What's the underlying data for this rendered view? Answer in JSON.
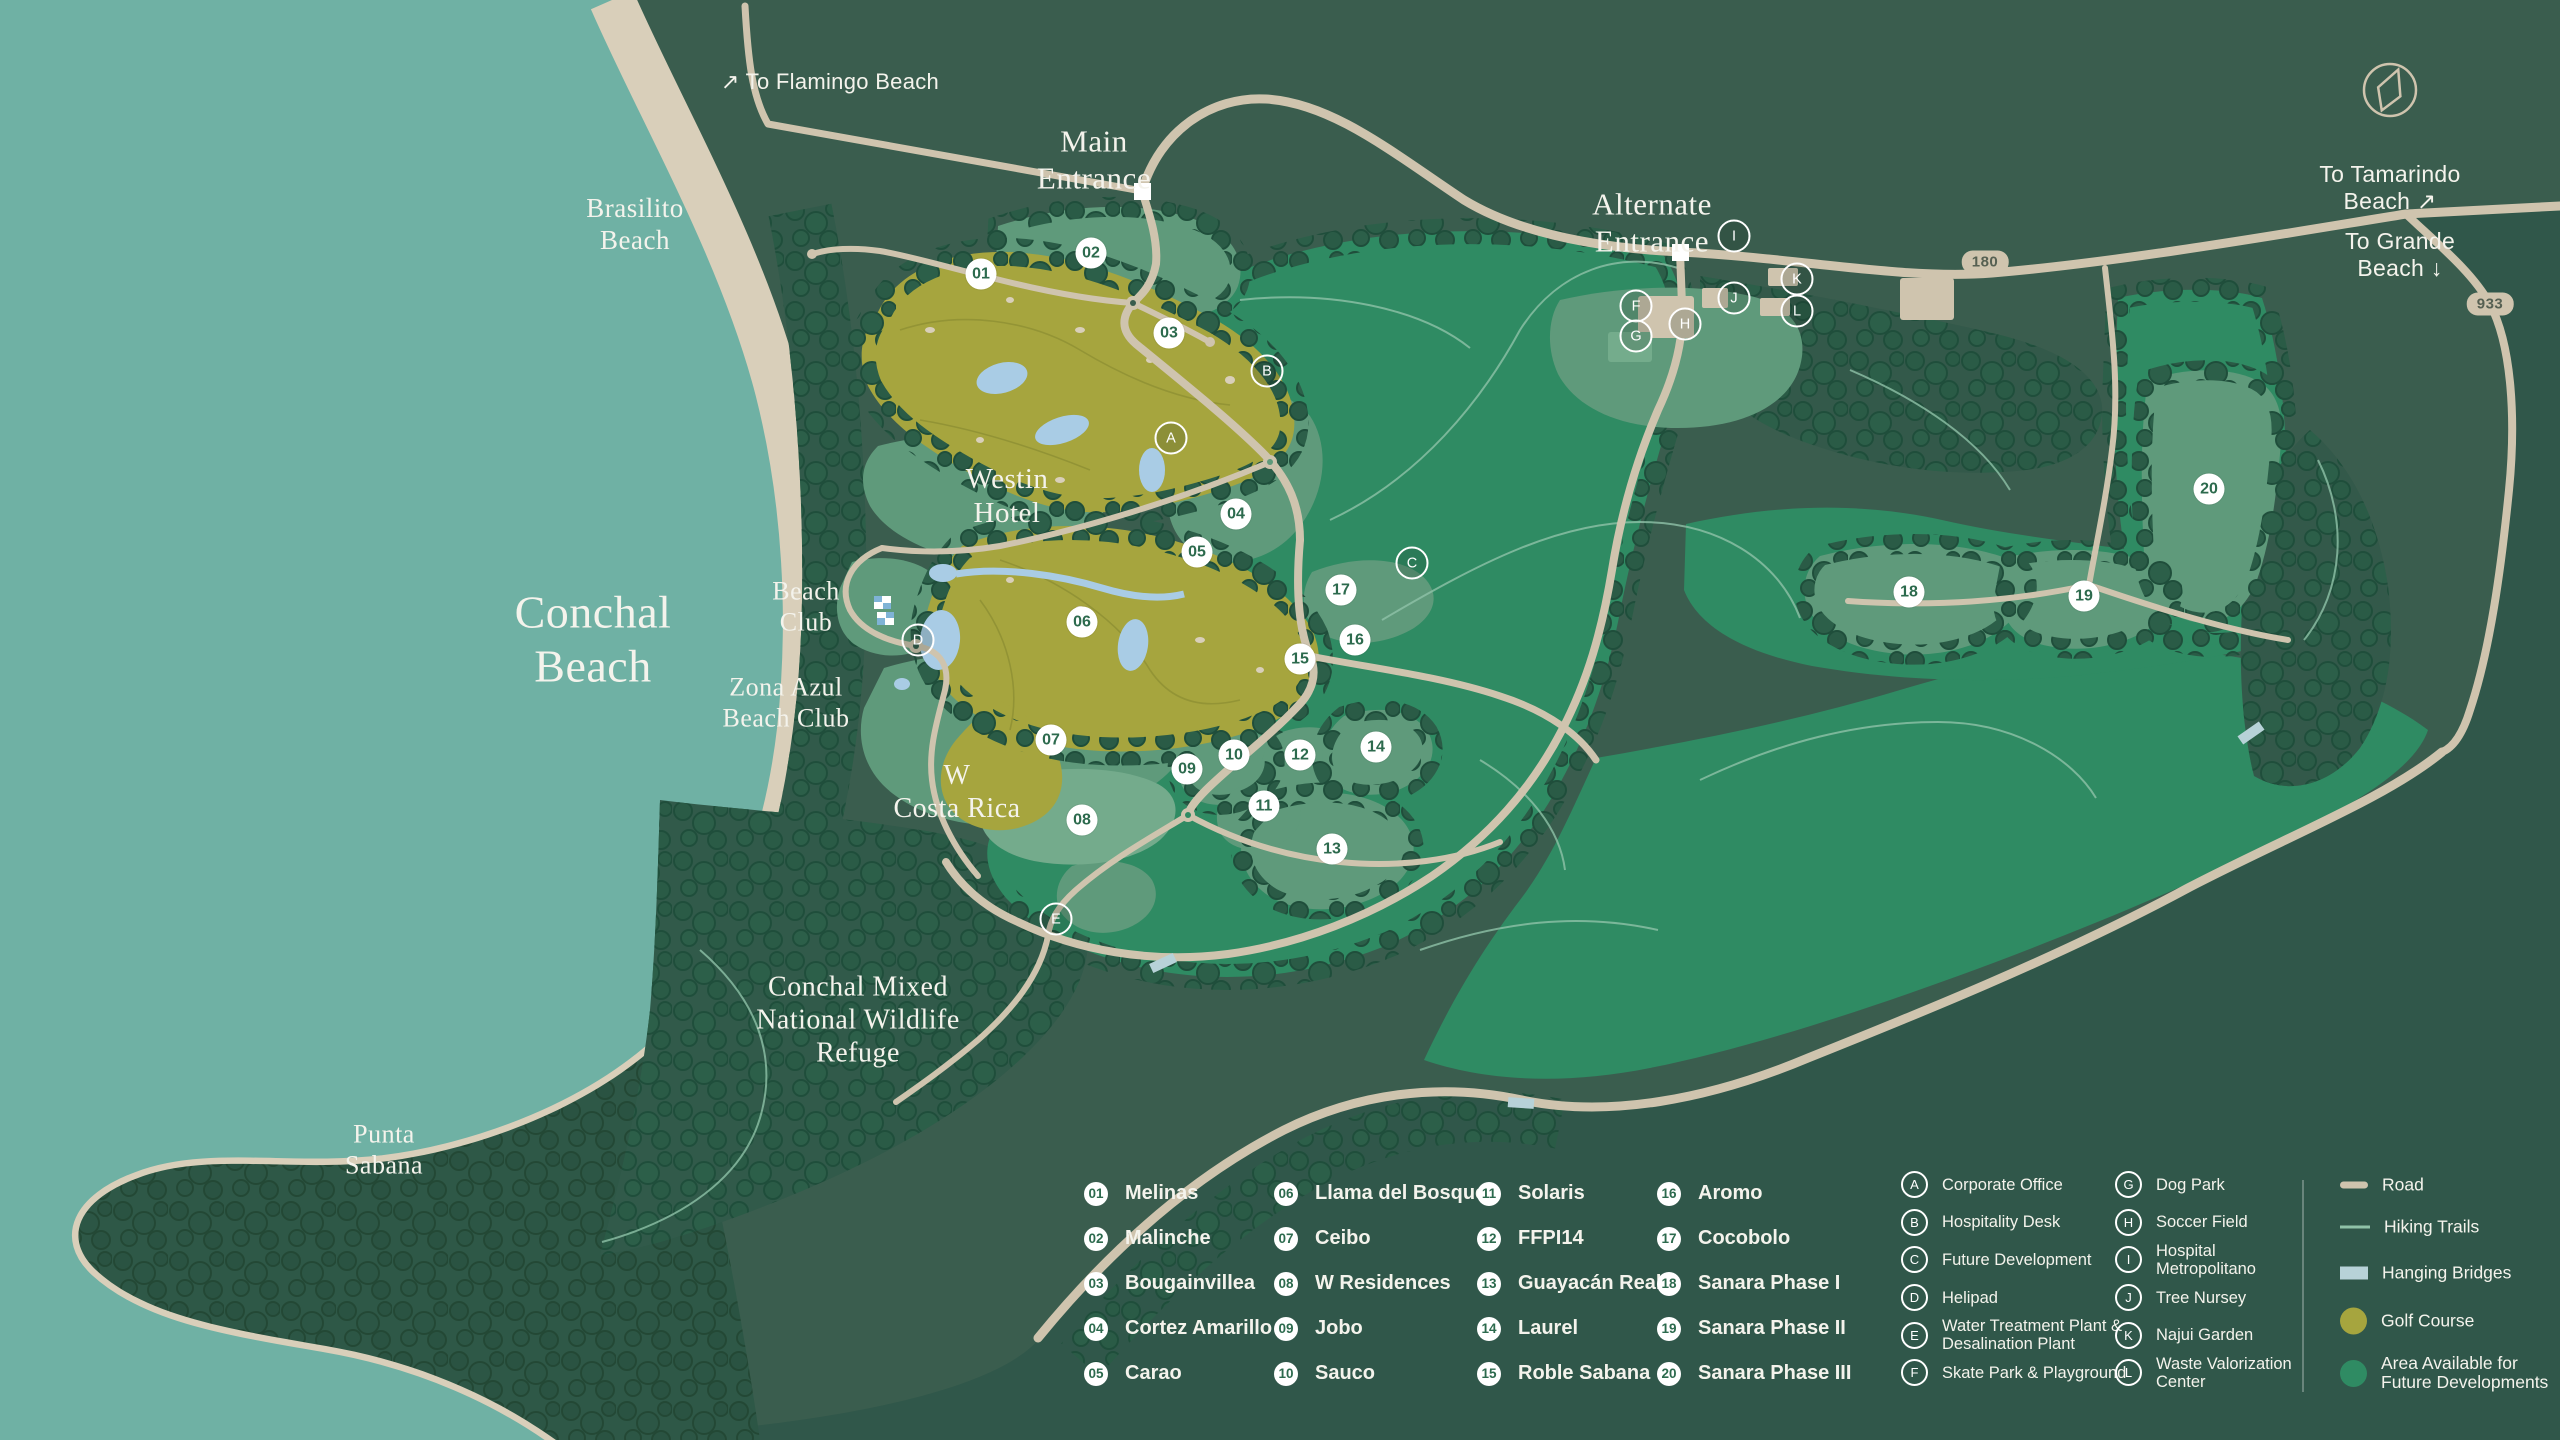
{
  "map": {
    "region_labels": [
      {
        "name": "to-flamingo-beach",
        "text": "↗  To Flamingo Beach",
        "x": 830,
        "y": 82,
        "font": "sans",
        "size": 22
      },
      {
        "name": "brasilito-beach",
        "text": "Brasilito\nBeach",
        "x": 635,
        "y": 225,
        "font": "serif",
        "size": 27
      },
      {
        "name": "main-entrance",
        "text": "Main\nEntrance",
        "x": 1094,
        "y": 160,
        "font": "serif",
        "size": 31
      },
      {
        "name": "alternate-entrance",
        "text": "Alternate\nEntrance",
        "x": 1652,
        "y": 223,
        "font": "serif",
        "size": 31
      },
      {
        "name": "to-tamarindo-beach",
        "text": "To Tamarindo Beach ↗",
        "x": 2390,
        "y": 188,
        "font": "sans",
        "size": 23
      },
      {
        "name": "to-grande-beach",
        "text": "To Grande Beach ↓",
        "x": 2400,
        "y": 255,
        "font": "sans",
        "size": 23
      },
      {
        "name": "conchal-beach",
        "text": "Conchal\nBeach",
        "x": 593,
        "y": 640,
        "font": "serif",
        "size": 46
      },
      {
        "name": "westin-hotel",
        "text": "Westin\nHotel",
        "x": 1007,
        "y": 496,
        "font": "serif",
        "size": 29
      },
      {
        "name": "beach-club",
        "text": "Beach\nClub",
        "x": 806,
        "y": 607,
        "font": "serif",
        "size": 26
      },
      {
        "name": "zona-azul-beach-club",
        "text": "Zona Azul\nBeach Club",
        "x": 786,
        "y": 703,
        "font": "serif",
        "size": 26
      },
      {
        "name": "w-costa-rica",
        "text": "W\nCosta Rica",
        "x": 957,
        "y": 792,
        "font": "serif",
        "size": 28
      },
      {
        "name": "wildlife-refuge",
        "text": "Conchal Mixed\nNational Wildlife\nRefuge",
        "x": 858,
        "y": 1020,
        "font": "serif",
        "size": 28
      },
      {
        "name": "punta-sabana",
        "text": "Punta\nSabana",
        "x": 384,
        "y": 1150,
        "font": "serif",
        "size": 26
      }
    ],
    "road_badges": [
      {
        "text": "180",
        "x": 1985,
        "y": 262
      },
      {
        "text": "933",
        "x": 2490,
        "y": 304
      }
    ],
    "markers_numbered": [
      {
        "id": "01",
        "x": 981,
        "y": 274
      },
      {
        "id": "02",
        "x": 1091,
        "y": 253
      },
      {
        "id": "03",
        "x": 1169,
        "y": 333
      },
      {
        "id": "04",
        "x": 1236,
        "y": 514
      },
      {
        "id": "05",
        "x": 1197,
        "y": 552
      },
      {
        "id": "06",
        "x": 1082,
        "y": 622
      },
      {
        "id": "07",
        "x": 1051,
        "y": 740
      },
      {
        "id": "08",
        "x": 1082,
        "y": 820
      },
      {
        "id": "09",
        "x": 1187,
        "y": 769
      },
      {
        "id": "10",
        "x": 1234,
        "y": 755
      },
      {
        "id": "11",
        "x": 1264,
        "y": 806
      },
      {
        "id": "12",
        "x": 1300,
        "y": 755
      },
      {
        "id": "13",
        "x": 1332,
        "y": 849
      },
      {
        "id": "14",
        "x": 1376,
        "y": 747
      },
      {
        "id": "15",
        "x": 1300,
        "y": 659
      },
      {
        "id": "16",
        "x": 1355,
        "y": 640
      },
      {
        "id": "17",
        "x": 1341,
        "y": 590
      },
      {
        "id": "18",
        "x": 1909,
        "y": 592
      },
      {
        "id": "19",
        "x": 2084,
        "y": 596
      },
      {
        "id": "20",
        "x": 2209,
        "y": 489
      }
    ],
    "markers_lettered": [
      {
        "id": "A",
        "x": 1171,
        "y": 438
      },
      {
        "id": "B",
        "x": 1267,
        "y": 371
      },
      {
        "id": "C",
        "x": 1412,
        "y": 563
      },
      {
        "id": "D",
        "x": 918,
        "y": 640
      },
      {
        "id": "E",
        "x": 1056,
        "y": 919
      },
      {
        "id": "F",
        "x": 1636,
        "y": 306
      },
      {
        "id": "G",
        "x": 1636,
        "y": 336
      },
      {
        "id": "H",
        "x": 1685,
        "y": 324
      },
      {
        "id": "I",
        "x": 1734,
        "y": 236
      },
      {
        "id": "J",
        "x": 1734,
        "y": 298
      },
      {
        "id": "K",
        "x": 1797,
        "y": 279
      },
      {
        "id": "L",
        "x": 1797,
        "y": 311
      }
    ]
  },
  "legend": {
    "numbered_columns": [
      [
        {
          "id": "01",
          "label": "Melinas"
        },
        {
          "id": "02",
          "label": "Malinche"
        },
        {
          "id": "03",
          "label": "Bougainvillea"
        },
        {
          "id": "04",
          "label": "Cortez Amarillo"
        },
        {
          "id": "05",
          "label": "Carao"
        }
      ],
      [
        {
          "id": "06",
          "label": "Llama del Bosque"
        },
        {
          "id": "07",
          "label": "Ceibo"
        },
        {
          "id": "08",
          "label": "W Residences"
        },
        {
          "id": "09",
          "label": "Jobo"
        },
        {
          "id": "10",
          "label": "Sauco"
        }
      ],
      [
        {
          "id": "11",
          "label": "Solaris"
        },
        {
          "id": "12",
          "label": "FFPI14"
        },
        {
          "id": "13",
          "label": "Guayacán Real"
        },
        {
          "id": "14",
          "label": "Laurel"
        },
        {
          "id": "15",
          "label": "Roble Sabana"
        }
      ],
      [
        {
          "id": "16",
          "label": "Aromo"
        },
        {
          "id": "17",
          "label": "Cocobolo"
        },
        {
          "id": "18",
          "label": "Sanara Phase I"
        },
        {
          "id": "19",
          "label": "Sanara Phase II"
        },
        {
          "id": "20",
          "label": "Sanara Phase III"
        }
      ]
    ],
    "lettered_columns": [
      [
        {
          "id": "A",
          "label": "Corporate Office"
        },
        {
          "id": "B",
          "label": "Hospitality Desk"
        },
        {
          "id": "C",
          "label": "Future Development"
        },
        {
          "id": "D",
          "label": "Helipad"
        },
        {
          "id": "E",
          "label": "Water Treatment Plant &\nDesalination Plant"
        },
        {
          "id": "F",
          "label": "Skate Park & Playground"
        }
      ],
      [
        {
          "id": "G",
          "label": "Dog Park"
        },
        {
          "id": "H",
          "label": "Soccer Field"
        },
        {
          "id": "I",
          "label": "Hospital\nMetropolitano"
        },
        {
          "id": "J",
          "label": "Tree Nursey"
        },
        {
          "id": "K",
          "label": "Najui Garden"
        },
        {
          "id": "L",
          "label": "Waste Valorization\nCenter"
        }
      ]
    ],
    "key_items": [
      {
        "swatch": "road",
        "label": "Road"
      },
      {
        "swatch": "trail",
        "label": "Hiking Trails"
      },
      {
        "swatch": "bridge",
        "label": "Hanging Bridges"
      },
      {
        "swatch": "golf",
        "label": "Golf Course"
      },
      {
        "swatch": "area",
        "label": "Area Available for\nFuture Developments"
      }
    ]
  },
  "colors": {
    "ocean": "#6FB1A4",
    "sand": "#D9CFBA",
    "road": "#CFC4AE",
    "land": "#3A5D4E",
    "land_dark": "#30574A",
    "emerald": "#2F8B63",
    "sage": "#5F9A7B",
    "sage_light": "#74AB8C",
    "golf": "#A6A53E",
    "water": "#A9CCE5",
    "bridge": "#B7D2D8",
    "trail": "#8FC2A8",
    "marker_text": "#2C6A4D",
    "text": "#F4F3EC"
  }
}
